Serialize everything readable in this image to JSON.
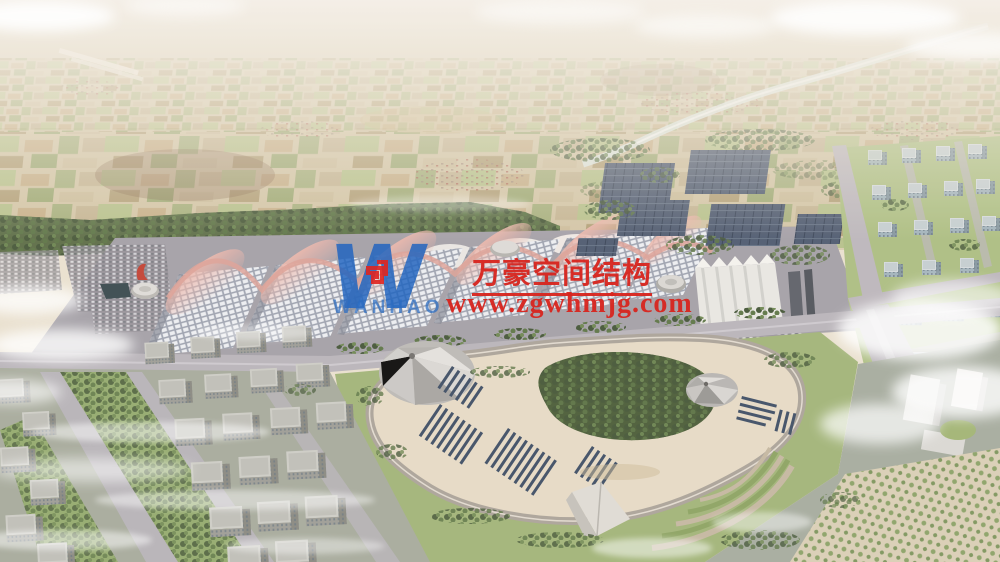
{
  "watermark": {
    "company_cn": "万豪空间结构",
    "url": "www.zgwhmjg.com",
    "logo_letter": "W",
    "logo_text": "WANHAO",
    "colors": {
      "watermark_red": "#d8251e",
      "logo_blue": "#1e63c0",
      "emblem_red": "#e02520"
    }
  }
}
